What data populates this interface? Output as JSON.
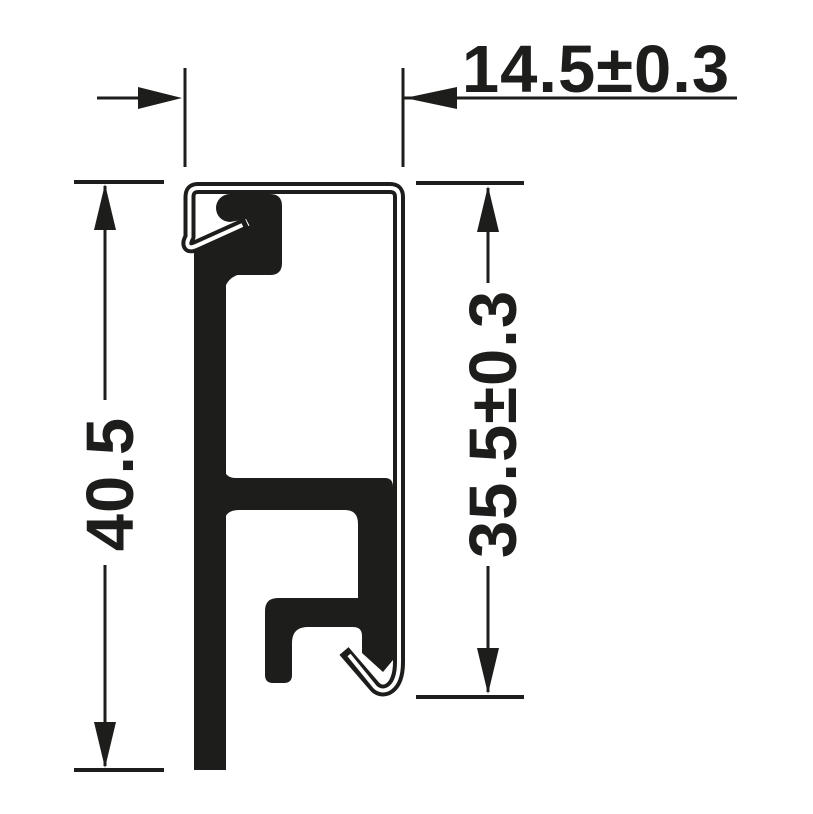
{
  "drawing": {
    "type": "profile-cross-section-dimension-drawing",
    "ink_color": "#1d1d1b",
    "background_color": "#ffffff",
    "dimensions": {
      "width_top": {
        "label": "14.5±0.3",
        "value": 14.5,
        "tolerance": 0.3,
        "orientation": "horizontal"
      },
      "height_overall": {
        "label": "40.5",
        "value": 40.5,
        "orientation": "vertical"
      },
      "height_right": {
        "label": "35.5±0.3",
        "value": 35.5,
        "tolerance": 0.3,
        "orientation": "vertical"
      }
    }
  }
}
